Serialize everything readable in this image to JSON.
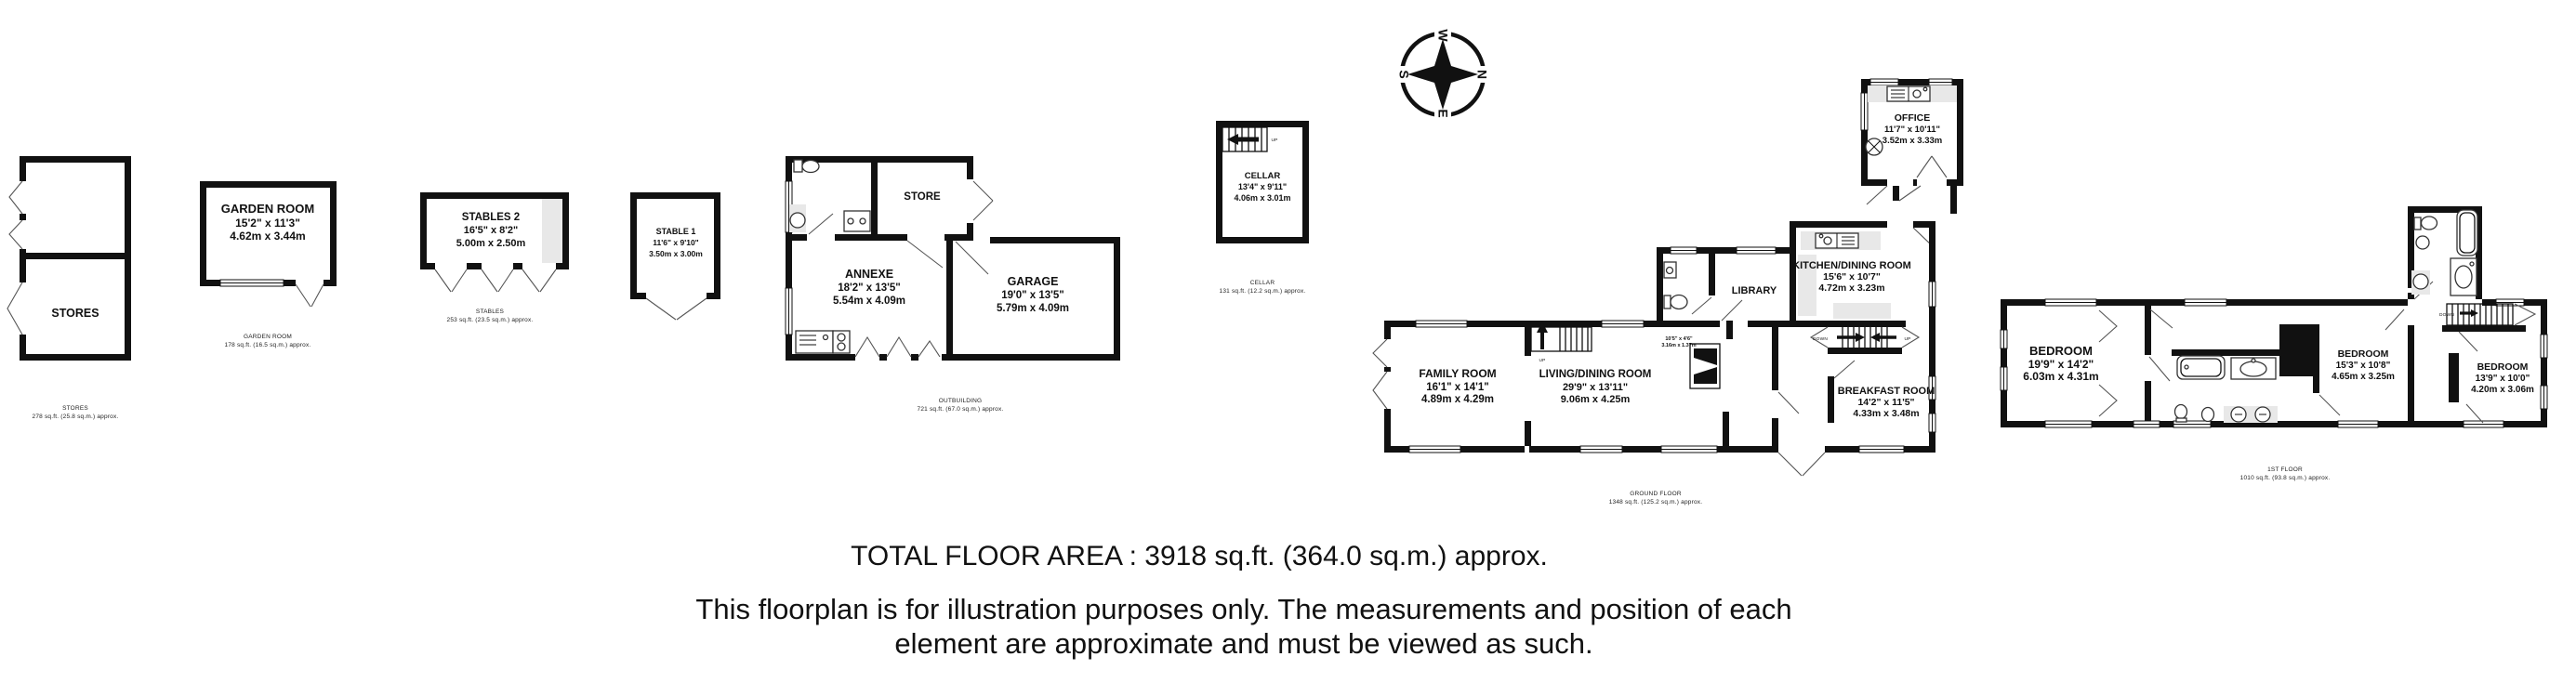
{
  "footer": {
    "total_area": "TOTAL FLOOR AREA : 3918 sq.ft. (364.0 sq.m.) approx.",
    "disclaimer_line1": "This floorplan is for illustration purposes only. The measurements and position of each",
    "disclaimer_line2": "element are approximate and must be viewed as such."
  },
  "compass": {
    "north": "N",
    "south": "S",
    "east": "E",
    "west": "W"
  },
  "stairs": {
    "cellar_up": "UP",
    "ground_up": "UP",
    "hall_down": "DOWN",
    "hall_up": "UP",
    "first_down": "DOWN"
  },
  "buildings": {
    "stores": {
      "label": "STORES",
      "caption_title": "STORES",
      "caption_area": "278 sq.ft. (25.8 sq.m.) approx."
    },
    "garden_room": {
      "label": "GARDEN ROOM",
      "imperial": "15'2\" x 11'3\"",
      "metric": "4.62m x 3.44m",
      "caption_title": "GARDEN ROOM",
      "caption_area": "178 sq.ft. (16.5 sq.m.) approx."
    },
    "stables2": {
      "label": "STABLES 2",
      "imperial": "16'5\" x 8'2\"",
      "metric": "5.00m x 2.50m",
      "caption_title": "STABLES",
      "caption_area": "253 sq.ft. (23.5 sq.m.) approx."
    },
    "stable1": {
      "label": "STABLE 1",
      "imperial": "11'6\" x 9'10\"",
      "metric": "3.50m x 3.00m"
    },
    "outbuilding": {
      "store": {
        "label": "STORE"
      },
      "annexe": {
        "label": "ANNEXE",
        "imperial": "18'2\" x 13'5\"",
        "metric": "5.54m x 4.09m"
      },
      "garage": {
        "label": "GARAGE",
        "imperial": "19'0\" x 13'5\"",
        "metric": "5.79m x 4.09m"
      },
      "caption_title": "OUTBUILDING",
      "caption_area": "721 sq.ft. (67.0 sq.m.) approx."
    },
    "cellar": {
      "label": "CELLAR",
      "imperial": "13'4\" x 9'11\"",
      "metric": "4.06m x 3.01m",
      "caption_title": "CELLAR",
      "caption_area": "131 sq.ft. (12.2 sq.m.) approx."
    },
    "office": {
      "label": "OFFICE",
      "imperial": "11'7\" x 10'11\"",
      "metric": "3.52m x 3.33m"
    },
    "ground_floor": {
      "family_room": {
        "label": "FAMILY ROOM",
        "imperial": "16'1\" x 14'1\"",
        "metric": "4.89m x 4.29m"
      },
      "living_dining_room": {
        "label": "LIVING/DINING ROOM",
        "imperial": "29'9\" x 13'11\"",
        "metric": "9.06m x 4.25m"
      },
      "library": {
        "label": "LIBRARY"
      },
      "kitchen_dining_room": {
        "label": "KITCHEN/DINING ROOM",
        "imperial": "15'6\" x 10'7\"",
        "metric": "4.72m x 3.23m"
      },
      "breakfast_room": {
        "label": "BREAKFAST ROOM",
        "imperial": "14'2\" x 11'5\"",
        "metric": "4.33m x 3.48m"
      },
      "inglenook": {
        "imperial": "10'5\" x 4'6\"",
        "metric": "3.16m x 1.37m"
      },
      "caption_title": "GROUND FLOOR",
      "caption_area": "1348 sq.ft. (125.2 sq.m.) approx."
    },
    "first_floor": {
      "bedroom1": {
        "label": "BEDROOM",
        "imperial": "19'9\" x 14'2\"",
        "metric": "6.03m x 4.31m"
      },
      "bedroom2": {
        "label": "BEDROOM",
        "imperial": "15'3\" x 10'8\"",
        "metric": "4.65m x 3.25m"
      },
      "bedroom3": {
        "label": "BEDROOM",
        "imperial": "13'9\" x 10'0\"",
        "metric": "4.20m x 3.06m"
      },
      "caption_title": "1ST FLOOR",
      "caption_area": "1010 sq.ft. (93.8 sq.m.) approx."
    }
  }
}
